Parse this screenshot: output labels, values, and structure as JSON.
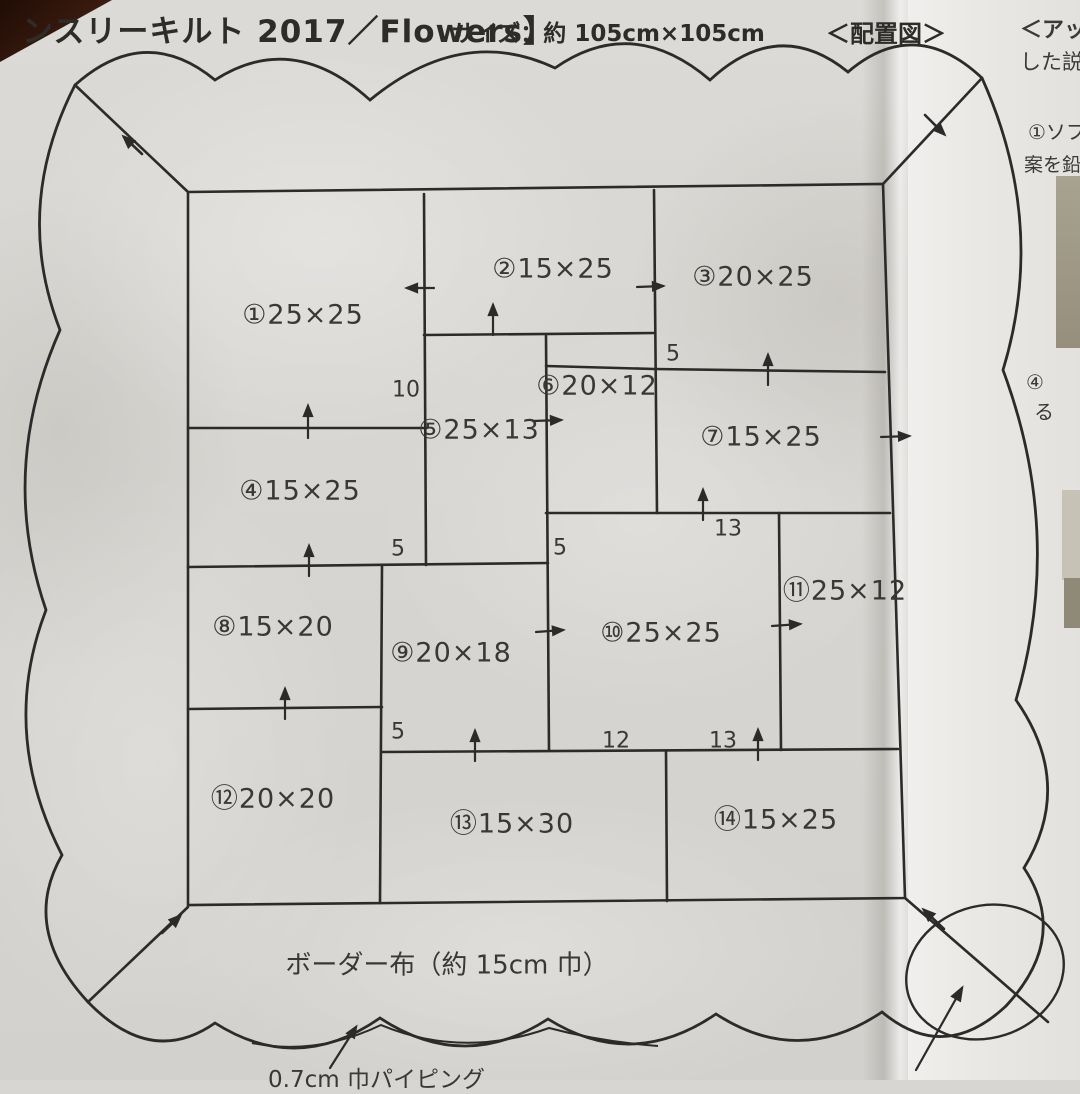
{
  "page": {
    "title_partial": "ンスリーキルト 2017／Flowers】",
    "size_label": "サイズ：約 105cm×105cm",
    "diagram_caption": "＜配置図＞"
  },
  "diagram": {
    "blocks": [
      "①25×25",
      "②15×25",
      "③20×25",
      "④15×25",
      "⑤25×13",
      "⑥20×12",
      "⑦15×25",
      "⑧15×20",
      "⑨20×18",
      "⑩25×25",
      "⑪25×12",
      "⑫20×20",
      "⑬15×30",
      "⑭15×25"
    ],
    "strip_numbers": [
      "10",
      "5",
      "5",
      "5",
      "13",
      "5",
      "12",
      "13"
    ],
    "border_label": "ボーダー布（約 15cm 巾）",
    "piping_label": "0.7cm 巾パイピング"
  },
  "side_column": {
    "snippets": [
      "＜アッ",
      "した説",
      "①ソフ",
      "案を鉛",
      "④",
      "る"
    ]
  },
  "colors": {
    "paper": "#d8d6d2",
    "ink": "#2c2b29",
    "corner_shadow": "#3a1a0e"
  }
}
